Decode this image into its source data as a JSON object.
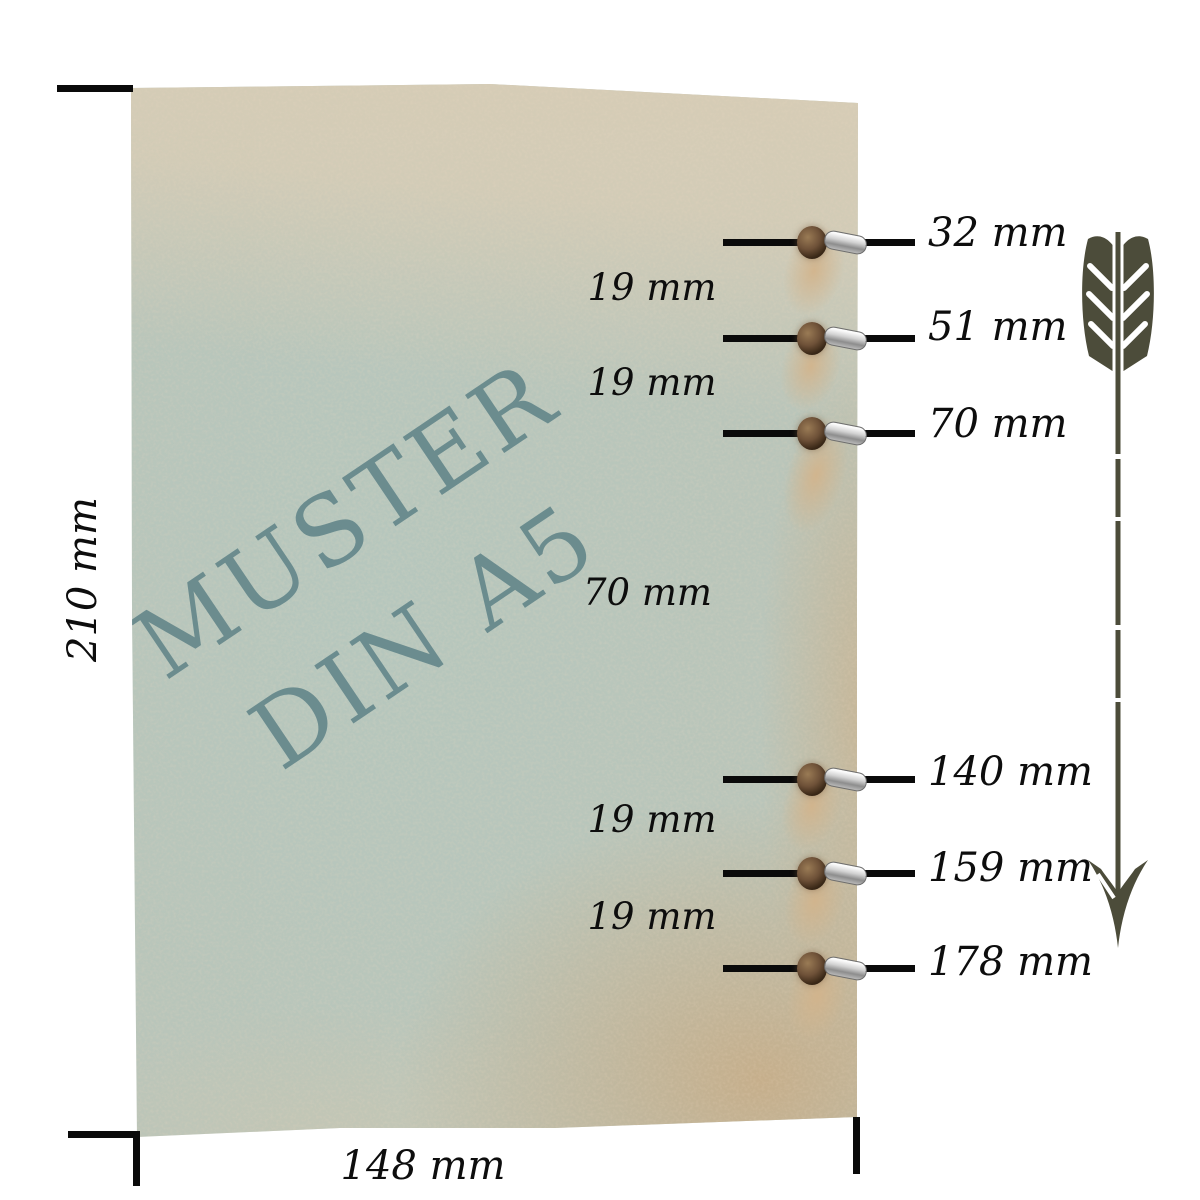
{
  "watermark": {
    "line1": "MUSTER",
    "line2": "DIN A5"
  },
  "measurements": {
    "sheet_height": "210 mm",
    "sheet_width": "148 mm",
    "holes": [
      {
        "label": "32 mm"
      },
      {
        "label": "51 mm"
      },
      {
        "label": "70 mm"
      },
      {
        "label": "140 mm"
      },
      {
        "label": "159 mm"
      },
      {
        "label": "178 mm"
      }
    ],
    "gaps": [
      {
        "label": "19 mm"
      },
      {
        "label": "19 mm"
      },
      {
        "label": "70 mm"
      },
      {
        "label": "19 mm"
      },
      {
        "label": "19 mm"
      }
    ]
  },
  "colors": {
    "paper_teal": "#b9c5ba",
    "paper_beige": "#d8cdb6",
    "paper_tan_edge": "#c7ac86",
    "watermark": "#5e8287",
    "annotation": "#0a0a0a",
    "arrow": "#4c4c3a",
    "eyelet_brown": "#6e5138",
    "eyelet_silver": "#d2d2d2"
  }
}
